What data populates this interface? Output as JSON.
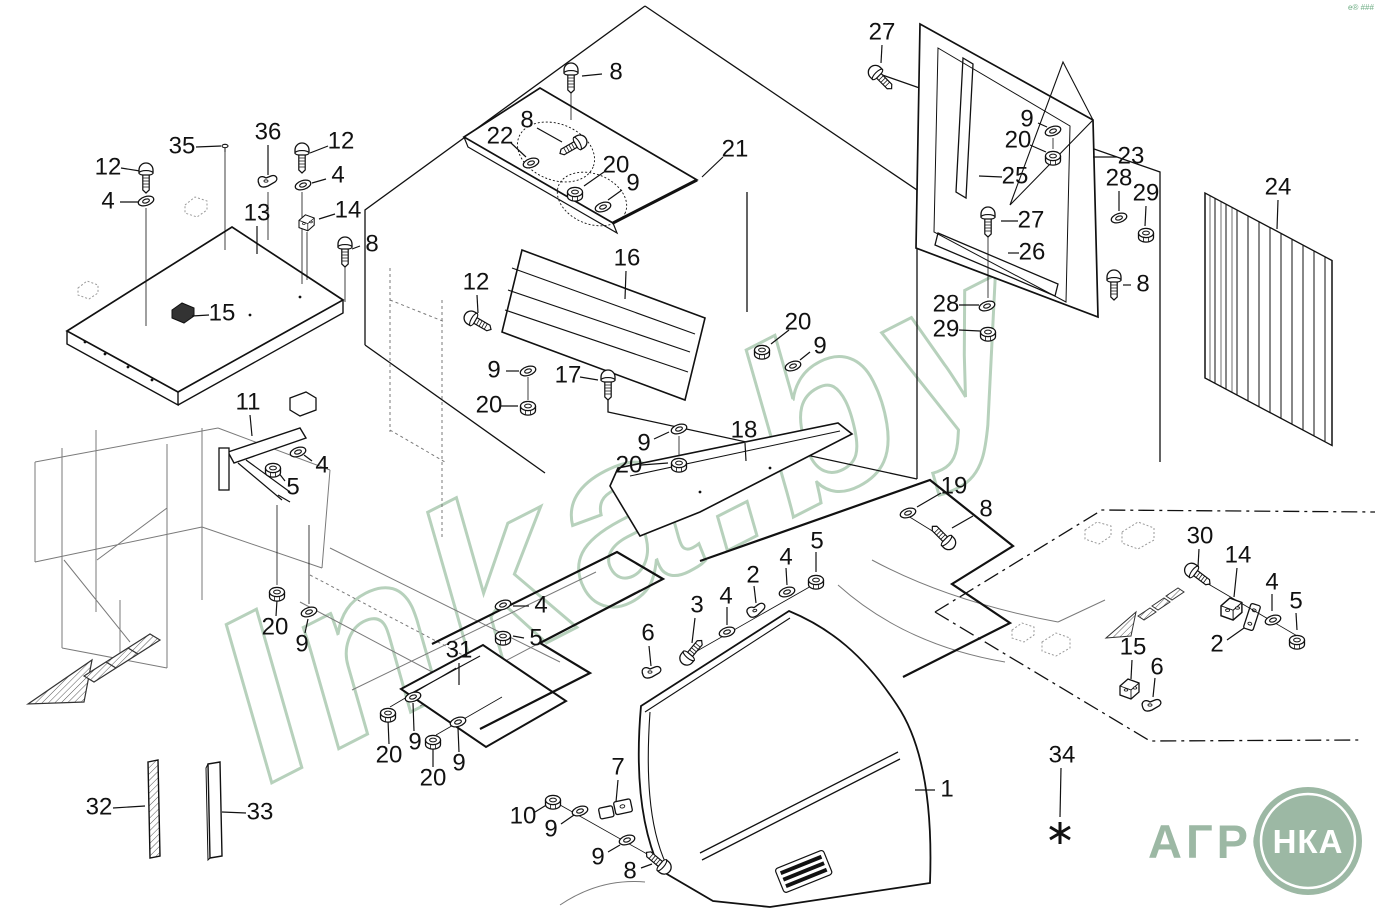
{
  "canvas": {
    "width": 1379,
    "height": 918,
    "background": "#ffffff",
    "line_color": "#111111"
  },
  "watermark": {
    "text": "Inka.by",
    "color": "#b7d1bc",
    "rotation": -27
  },
  "corner_mark": {
    "text": "e® ###",
    "color": "#6fae85"
  },
  "logo": {
    "word": "АГРО",
    "circle_word": "НКА",
    "color": "#9cb8a4"
  },
  "footnote": {
    "label": "34",
    "symbol": "*"
  },
  "part_numbers_visible": [
    "1",
    "2",
    "3",
    "4",
    "5",
    "6",
    "7",
    "8",
    "9",
    "10",
    "11",
    "12",
    "13",
    "14",
    "15",
    "16",
    "17",
    "18",
    "19",
    "20",
    "21",
    "22",
    "23",
    "24",
    "25",
    "26",
    "27",
    "28",
    "29",
    "30",
    "31",
    "32",
    "33",
    "34",
    "35",
    "36"
  ],
  "labels": [
    [
      "12",
      108,
      168,
      121,
      168,
      140,
      171
    ],
    [
      "4",
      108,
      202,
      120,
      202,
      140,
      202
    ],
    [
      "35",
      182,
      147,
      196,
      147,
      221,
      146
    ],
    [
      "36",
      268,
      133,
      268,
      145,
      268,
      175
    ],
    [
      "12",
      341,
      142,
      328,
      146,
      310,
      153
    ],
    [
      "4",
      338,
      176,
      326,
      179,
      312,
      183
    ],
    [
      "13",
      257,
      214,
      257,
      226,
      257,
      254
    ],
    [
      "14",
      348,
      211,
      335,
      214,
      319,
      219
    ],
    [
      "8",
      372,
      245,
      360,
      246,
      352,
      249
    ],
    [
      "15",
      222,
      314,
      209,
      315,
      192,
      316
    ],
    [
      "11",
      248,
      403,
      250,
      415,
      252,
      436
    ],
    [
      "4",
      322,
      466,
      312,
      461,
      304,
      455
    ],
    [
      "5",
      293,
      488,
      285,
      481,
      278,
      472
    ],
    [
      "20",
      275,
      628,
      276,
      616,
      277,
      600
    ],
    [
      "9",
      302,
      645,
      305,
      633,
      308,
      619
    ],
    [
      "32",
      99,
      808,
      113,
      808,
      145,
      806
    ],
    [
      "33",
      260,
      813,
      246,
      813,
      222,
      812
    ],
    [
      "8",
      616,
      73,
      602,
      74,
      582,
      76
    ],
    [
      "8",
      527,
      121,
      537,
      128,
      562,
      142
    ],
    [
      "22",
      500,
      137,
      511,
      143,
      526,
      157
    ],
    [
      "20",
      616,
      166,
      604,
      172,
      584,
      186
    ],
    [
      "9",
      633,
      184,
      622,
      190,
      608,
      200
    ],
    [
      "21",
      735,
      150,
      723,
      157,
      702,
      177
    ],
    [
      "16",
      627,
      259,
      626,
      271,
      625,
      299
    ],
    [
      "12",
      476,
      283,
      477,
      295,
      478,
      313
    ],
    [
      "9",
      494,
      371,
      506,
      371,
      519,
      371
    ],
    [
      "20",
      489,
      406,
      501,
      406,
      518,
      406
    ],
    [
      "17",
      568,
      376,
      580,
      377,
      598,
      380
    ],
    [
      "9",
      644,
      444,
      654,
      439,
      669,
      432
    ],
    [
      "20",
      629,
      466,
      641,
      465,
      668,
      463
    ],
    [
      "18",
      744,
      431,
      745,
      443,
      746,
      461
    ],
    [
      "20",
      798,
      323,
      789,
      330,
      771,
      344
    ],
    [
      "9",
      820,
      347,
      810,
      352,
      800,
      360
    ],
    [
      "19",
      954,
      487,
      941,
      493,
      917,
      507
    ],
    [
      "8",
      986,
      510,
      973,
      516,
      952,
      528
    ],
    [
      "27",
      882,
      33,
      882,
      45,
      881,
      63
    ],
    [
      "9",
      1027,
      120,
      1038,
      123,
      1047,
      127
    ],
    [
      "20",
      1018,
      141,
      1030,
      145,
      1046,
      152
    ],
    [
      "23",
      1131,
      157,
      1117,
      157,
      1093,
      157
    ],
    [
      "25",
      1015,
      177,
      1002,
      177,
      979,
      176
    ],
    [
      "28",
      1119,
      179,
      1119,
      191,
      1119,
      211
    ],
    [
      "29",
      1146,
      194,
      1146,
      206,
      1145,
      226
    ],
    [
      "27",
      1031,
      221,
      1018,
      221,
      1001,
      221
    ],
    [
      "26",
      1032,
      253,
      1019,
      253,
      1008,
      253
    ],
    [
      "28",
      946,
      305,
      959,
      305,
      979,
      305
    ],
    [
      "29",
      946,
      330,
      959,
      330,
      980,
      331
    ],
    [
      "8",
      1143,
      285,
      1131,
      285,
      1123,
      285
    ],
    [
      "24",
      1278,
      188,
      1278,
      200,
      1277,
      229
    ],
    [
      "31",
      459,
      651,
      459,
      663,
      459,
      685
    ],
    [
      "20",
      389,
      756,
      389,
      744,
      388,
      720
    ],
    [
      "9",
      415,
      743,
      414,
      731,
      413,
      703
    ],
    [
      "20",
      433,
      779,
      433,
      767,
      433,
      747
    ],
    [
      "9",
      459,
      764,
      459,
      752,
      458,
      728
    ],
    [
      "4",
      541,
      606,
      529,
      606,
      513,
      606
    ],
    [
      "5",
      536,
      639,
      524,
      638,
      513,
      636
    ],
    [
      "6",
      648,
      634,
      649,
      646,
      651,
      666
    ],
    [
      "3",
      697,
      606,
      695,
      618,
      692,
      643
    ],
    [
      "4",
      726,
      597,
      727,
      607,
      727,
      625
    ],
    [
      "2",
      753,
      576,
      754,
      586,
      756,
      603
    ],
    [
      "4",
      786,
      558,
      786,
      568,
      787,
      585
    ],
    [
      "5",
      817,
      542,
      816,
      552,
      816,
      572
    ],
    [
      "7",
      618,
      768,
      618,
      780,
      616,
      802
    ],
    [
      "10",
      523,
      817,
      535,
      812,
      548,
      804
    ],
    [
      "9",
      551,
      830,
      561,
      824,
      574,
      815
    ],
    [
      "9",
      598,
      858,
      608,
      852,
      620,
      845
    ],
    [
      "8",
      630,
      872,
      641,
      868,
      652,
      864
    ],
    [
      "1",
      947,
      790,
      935,
      790,
      915,
      790
    ],
    [
      "30",
      1200,
      537,
      1199,
      549,
      1198,
      567
    ],
    [
      "14",
      1238,
      556,
      1237,
      568,
      1234,
      597
    ],
    [
      "4",
      1272,
      583,
      1272,
      594,
      1272,
      611
    ],
    [
      "5",
      1296,
      602,
      1296,
      613,
      1297,
      630
    ],
    [
      "2",
      1217,
      645,
      1227,
      640,
      1244,
      628
    ],
    [
      "15",
      1133,
      648,
      1132,
      660,
      1131,
      679
    ],
    [
      "6",
      1157,
      668,
      1155,
      678,
      1153,
      697
    ],
    [
      "34",
      1062,
      756,
      1061,
      768,
      1060,
      817
    ]
  ],
  "fasteners": [
    [
      "bv",
      146,
      178
    ],
    [
      "bv",
      302,
      158
    ],
    [
      "bv",
      345,
      252
    ],
    [
      "bv",
      571,
      78
    ],
    [
      "bv",
      608,
      385
    ],
    [
      "bv",
      988,
      222
    ],
    [
      "bv",
      1114,
      285
    ],
    [
      "bd",
      573,
      146,
      60
    ],
    [
      "bd",
      478,
      322,
      -60
    ],
    [
      "bd",
      881,
      78,
      -45
    ],
    [
      "bd",
      943,
      537,
      135
    ],
    [
      "bd",
      692,
      652,
      220
    ],
    [
      "bd",
      658,
      862,
      130
    ],
    [
      "bd",
      1198,
      575,
      -53
    ],
    [
      "w",
      146,
      201
    ],
    [
      "w",
      303,
      185
    ],
    [
      "w",
      531,
      163
    ],
    [
      "w",
      603,
      207
    ],
    [
      "w",
      298,
      452
    ],
    [
      "w",
      309,
      612
    ],
    [
      "w",
      528,
      371
    ],
    [
      "w",
      679,
      429
    ],
    [
      "w",
      793,
      366
    ],
    [
      "w",
      908,
      513
    ],
    [
      "w",
      1053,
      131
    ],
    [
      "w",
      1119,
      218
    ],
    [
      "w",
      987,
      306
    ],
    [
      "w",
      413,
      697
    ],
    [
      "w",
      458,
      722
    ],
    [
      "w",
      503,
      605
    ],
    [
      "w",
      727,
      632
    ],
    [
      "w",
      787,
      592
    ],
    [
      "w",
      580,
      811
    ],
    [
      "w",
      627,
      840
    ],
    [
      "w",
      1273,
      620
    ],
    [
      "n",
      273,
      468
    ],
    [
      "n",
      277,
      592
    ],
    [
      "n",
      575,
      192
    ],
    [
      "n",
      528,
      406
    ],
    [
      "n",
      679,
      463
    ],
    [
      "n",
      762,
      350
    ],
    [
      "n",
      1053,
      156
    ],
    [
      "n",
      1146,
      233
    ],
    [
      "n",
      988,
      332
    ],
    [
      "n",
      388,
      713
    ],
    [
      "n",
      433,
      740
    ],
    [
      "n",
      503,
      636
    ],
    [
      "n",
      816,
      580
    ],
    [
      "n",
      553,
      800
    ],
    [
      "n",
      1297,
      640
    ],
    [
      "p",
      225,
      146
    ],
    [
      "c",
      268,
      182
    ],
    [
      "c",
      652,
      673
    ],
    [
      "c",
      757,
      611,
      -15
    ],
    [
      "c",
      1152,
      706
    ],
    [
      "br",
      307,
      222,
      0,
      0.8
    ],
    [
      "br",
      1232,
      608,
      0,
      1.1
    ],
    [
      "br",
      1130,
      688
    ]
  ]
}
